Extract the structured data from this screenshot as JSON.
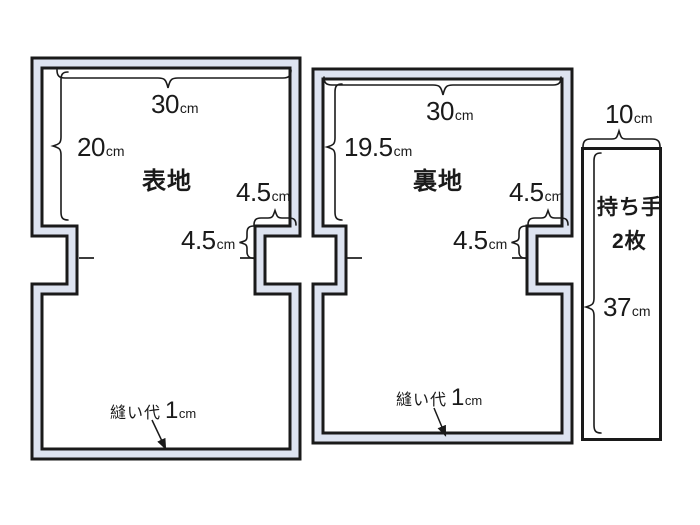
{
  "diagram_type": "bag sewing pattern cutting diagram",
  "colors": {
    "line": "#1a1a1a",
    "band": "#dde3f0",
    "background": "#ffffff"
  },
  "pieces": {
    "outer": {
      "name": "表地",
      "width": {
        "value": "30",
        "unit": "cm"
      },
      "height": {
        "value": "20",
        "unit": "cm"
      },
      "notch_width": {
        "value": "4.5",
        "unit": "cm"
      },
      "notch_height": {
        "value": "4.5",
        "unit": "cm"
      },
      "seam": {
        "label": "縫い代",
        "value": "1",
        "unit": "cm"
      }
    },
    "lining": {
      "name": "裏地",
      "width": {
        "value": "30",
        "unit": "cm"
      },
      "height": {
        "value": "19.5",
        "unit": "cm"
      },
      "notch_width": {
        "value": "4.5",
        "unit": "cm"
      },
      "notch_height": {
        "value": "4.5",
        "unit": "cm"
      },
      "seam": {
        "label": "縫い代",
        "value": "1",
        "unit": "cm"
      }
    },
    "handle": {
      "name": "持ち手",
      "count": "2枚",
      "width": {
        "value": "10",
        "unit": "cm"
      },
      "height": {
        "value": "37",
        "unit": "cm"
      }
    }
  }
}
